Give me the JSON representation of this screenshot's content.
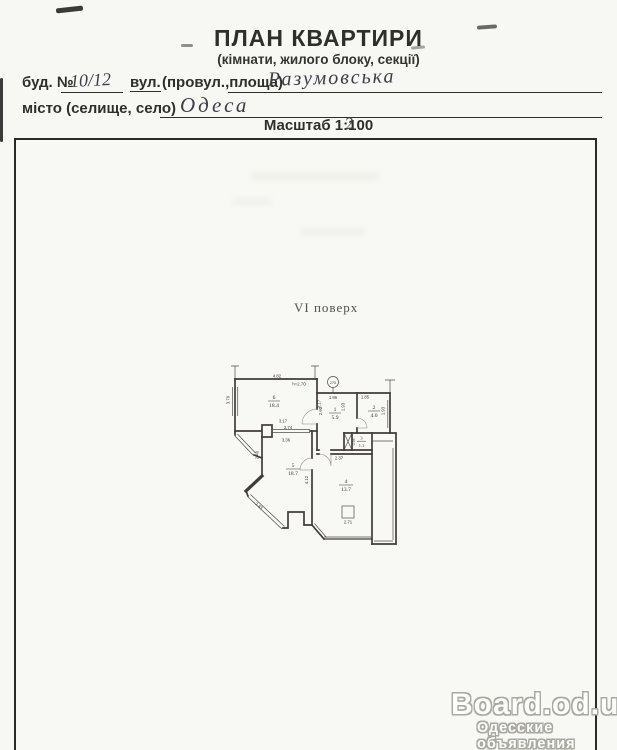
{
  "header": {
    "title": "ПЛАН КВАРТИРИ",
    "subtitle": "(кімнати, жилого блоку, секції)"
  },
  "form": {
    "building_label": "буд. №",
    "building_value": "10/12",
    "street_label": "вул.",
    "street_sublabel": "(провул.,площа)",
    "street_value": "Разумовська",
    "city_label": "місто (селище, село)",
    "city_value": "Одеса"
  },
  "scale": {
    "prefix": "Масштаб 1:",
    "printed_digit": "1",
    "correction": "2",
    "suffix": "00"
  },
  "plan": {
    "floor_label": "VI поверх",
    "apartment_number": "275",
    "rooms": [
      {
        "num": "1",
        "area": "5.9"
      },
      {
        "num": "2",
        "area": "4.0"
      },
      {
        "num": "3",
        "area": "1.1"
      },
      {
        "num": "4",
        "area": "13.7"
      },
      {
        "num": "5",
        "area": "18.7"
      },
      {
        "num": "6",
        "area": "18.4"
      }
    ],
    "dims": {
      "room6_top": "4.82",
      "room6_height": "h=2.70",
      "room6_left": "3.79",
      "room6_right": "3.17",
      "room6_bottom": "3.17",
      "opening": "2.74",
      "room5_top": "3.36",
      "room1_top": "1.96",
      "room2_top": "1.85",
      "room1_left": "2.60",
      "room1_right": "1.93",
      "room2_right": "1.93",
      "room3_left": "0.98",
      "room4_top": "2.37",
      "room5_left": "2.49",
      "room5_bay": "2.83",
      "room4_left": "4.12",
      "room4_bottom": "2.71"
    }
  },
  "watermark": {
    "title": "Board.od.ua",
    "subtitle": "Одесские объявления"
  }
}
